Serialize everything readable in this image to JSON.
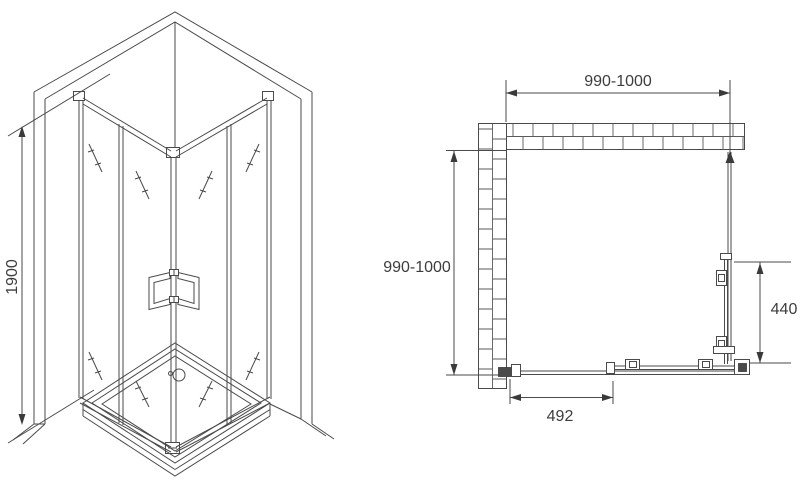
{
  "drawing": {
    "isometric_view": {
      "height_dimension": "1900"
    },
    "plan_view": {
      "width_dimension": "990-1000",
      "depth_dimension": "990-1000",
      "side_door_dimension": "440",
      "front_door_dimension": "492"
    },
    "colors": {
      "line": "#4a4a4a",
      "text": "#3d3d3d",
      "background": "#ffffff"
    }
  }
}
